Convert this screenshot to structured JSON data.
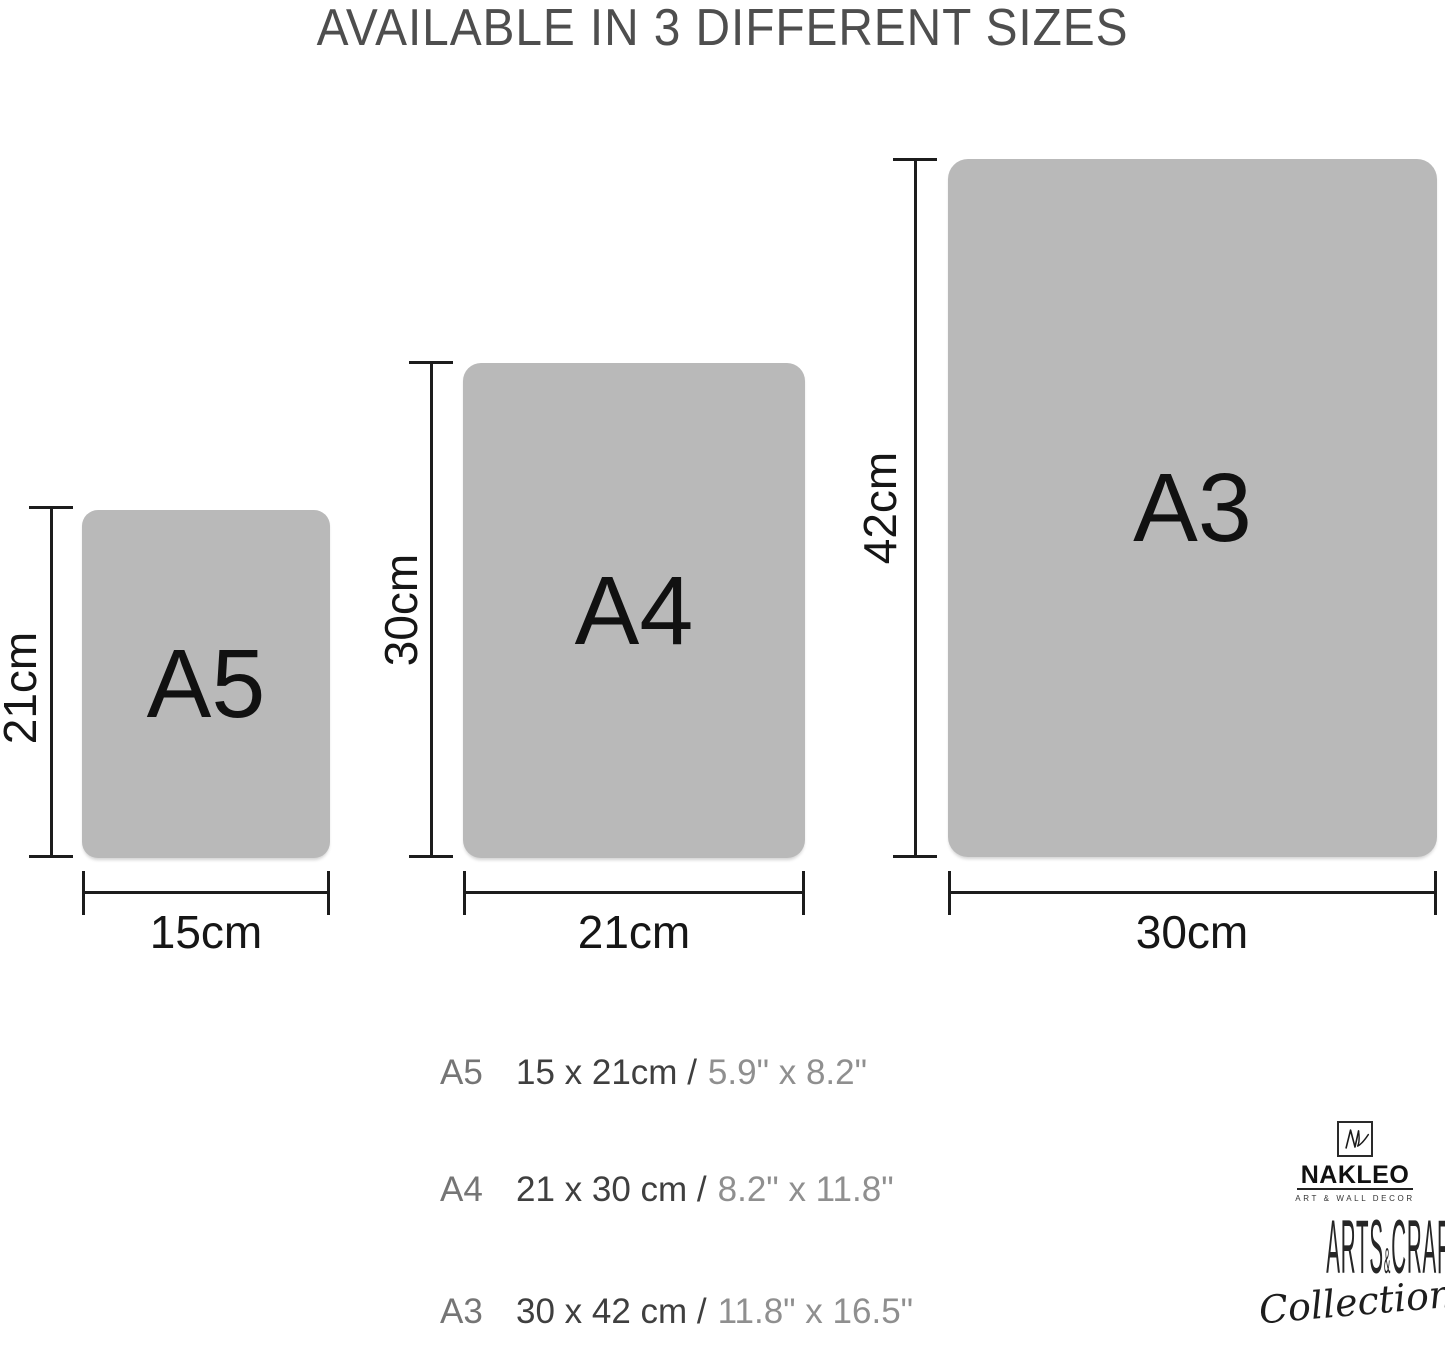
{
  "title": "AVAILABLE IN 3 DIFFERENT SIZES",
  "diagram": {
    "sizes": [
      {
        "name": "A5",
        "height_label": "21cm",
        "width_label": "15cm"
      },
      {
        "name": "A4",
        "height_label": "30cm",
        "width_label": "21cm"
      },
      {
        "name": "A3",
        "height_label": "42cm",
        "width_label": "30cm"
      }
    ]
  },
  "size_table": {
    "rows": [
      {
        "size": "A5",
        "metric": "15 x 21cm /",
        "imperial": "5.9\" x 8.2\""
      },
      {
        "size": "A4",
        "metric": "21 x 30 cm /",
        "imperial": "8.2\" x 11.8\""
      },
      {
        "size": "A3",
        "metric": "30 x 42 cm /",
        "imperial": "11.8\" x 16.5\""
      }
    ]
  },
  "logo": {
    "monogram": "NL",
    "brand": "NAKLEO",
    "tagline": "ART & WALL DECOR",
    "collection_left": "ARTS",
    "collection_amp": "&",
    "collection_right": "CRAFTS",
    "collection_script": "Collection"
  },
  "colors": {
    "panel_gray": "#b9b9b9",
    "dimension_line": "#1c1c1c",
    "title_gray": "#4e4e4e",
    "row_label_gray": "#757575",
    "row_metric_dark": "#3f3f3f",
    "row_imperial_gray": "#8f8f8f"
  }
}
